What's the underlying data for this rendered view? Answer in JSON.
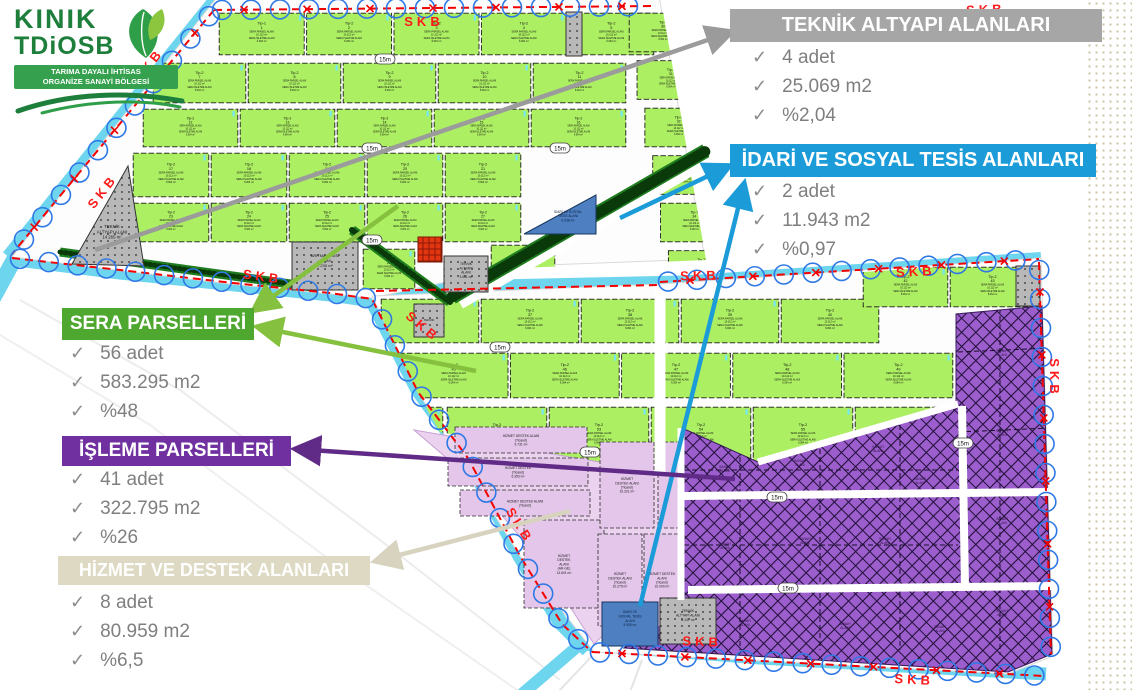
{
  "logo": {
    "line1": "KINIK",
    "line2": "TDiOSB",
    "banner_line1": "TARIMA DAYALI İHTİSAS",
    "banner_line2": "ORGANİZE SANAYİ BÖLGESİ"
  },
  "callouts": [
    {
      "key": "teknik",
      "title": "TEKNİK ALTYAPI ALANLARI",
      "color": "#A6A6A6",
      "items": [
        "4 adet",
        "25.069 m2",
        "%2,04"
      ]
    },
    {
      "key": "idari",
      "title": "İDARİ VE SOSYAL TESİS ALANLARI",
      "color": "#1B9CD8",
      "items": [
        "2 adet",
        "11.943 m2",
        "%0,97"
      ]
    },
    {
      "key": "sera",
      "title": "SERA PARSELLERİ",
      "color": "#4EA72E",
      "items": [
        "56 adet",
        "583.295 m2",
        "%48"
      ]
    },
    {
      "key": "isleme",
      "title": "İŞLEME PARSELLERİ",
      "color": "#7030A0",
      "items": [
        "41 adet",
        "322.795 m2",
        "%26"
      ]
    },
    {
      "key": "hizmet",
      "title": "HİZMET VE DESTEK ALANLARI",
      "color": "#DDD9C3",
      "items": [
        "8 adet",
        "80.959 m2",
        "%6,5"
      ]
    }
  ],
  "map": {
    "boundary_label": "SKB",
    "road_label": "15m",
    "sera_parcel": {
      "type_label": "Tip-2",
      "line1": "SERA PARSEL ALANI",
      "area1": "10.112 m²",
      "line2": "SERA İŞLETME ALANI",
      "area2": "6.064 m²"
    },
    "type_variants": {
      "1": "Tip-1",
      "23": "Tip-2",
      "28": "Tip-9",
      "29": "Tip-10",
      "30": "Tip-5",
      "31": "Tip-5",
      "32": "Tip-6",
      "33": "Tip-11",
      "34": "Tip-7",
      "35": "Tip-12",
      "44": "Tip-13"
    },
    "sanayi_label": [
      "SANAYİ",
      "ALANI"
    ],
    "special_parcels": {
      "teknik_west": [
        "TEKNİK",
        "ALTYAPI ALANI",
        "14.265 m²"
      ],
      "aritma": [
        "ARITMA TESİSİ",
        "ALANI",
        "7.230 m²"
      ],
      "idari_north": [
        "İDARİ VE SOSYAL",
        "TESİS ALANI",
        "6.038 m²"
      ],
      "idari_south": [
        "İDARİ VE",
        "SOSYAL TESİS",
        "ALANI",
        "5.905 m²"
      ],
      "teknik_mid": [
        "TEKNİK",
        "ALTYAPI",
        "ALANI",
        "3.001 m²"
      ],
      "teknik_junction": [
        "TEKNİK"
      ],
      "teknik_south": [
        "TEKNİK",
        "ALTYAPI ALANI",
        "6.137 m²"
      ],
      "hizmet_parcels": [
        [
          "HİZMET DESTEK ALANI",
          "(Ticaret)",
          "9.731 m²"
        ],
        [
          "HİZMET DESTEK",
          "(Ticaret)",
          "6.353 m²"
        ],
        [
          "HİZMET DESTEK ALANI",
          "(Ticaret)"
        ],
        [
          "HİZMET",
          "DESTEK",
          "ALANI",
          "(AR-GE)",
          "14.601 m²"
        ],
        [
          "HİZMET",
          "DESTEK ALANI",
          "(Ticaret)",
          "10.321 m²"
        ],
        [
          "HİZMET",
          "DESTEK ALANI",
          "(Ticaret)",
          "10.275 m²"
        ],
        [
          "HİZMET DESTEK",
          "ALANI",
          "(Ticaret)",
          "10.000 m²"
        ]
      ]
    }
  }
}
